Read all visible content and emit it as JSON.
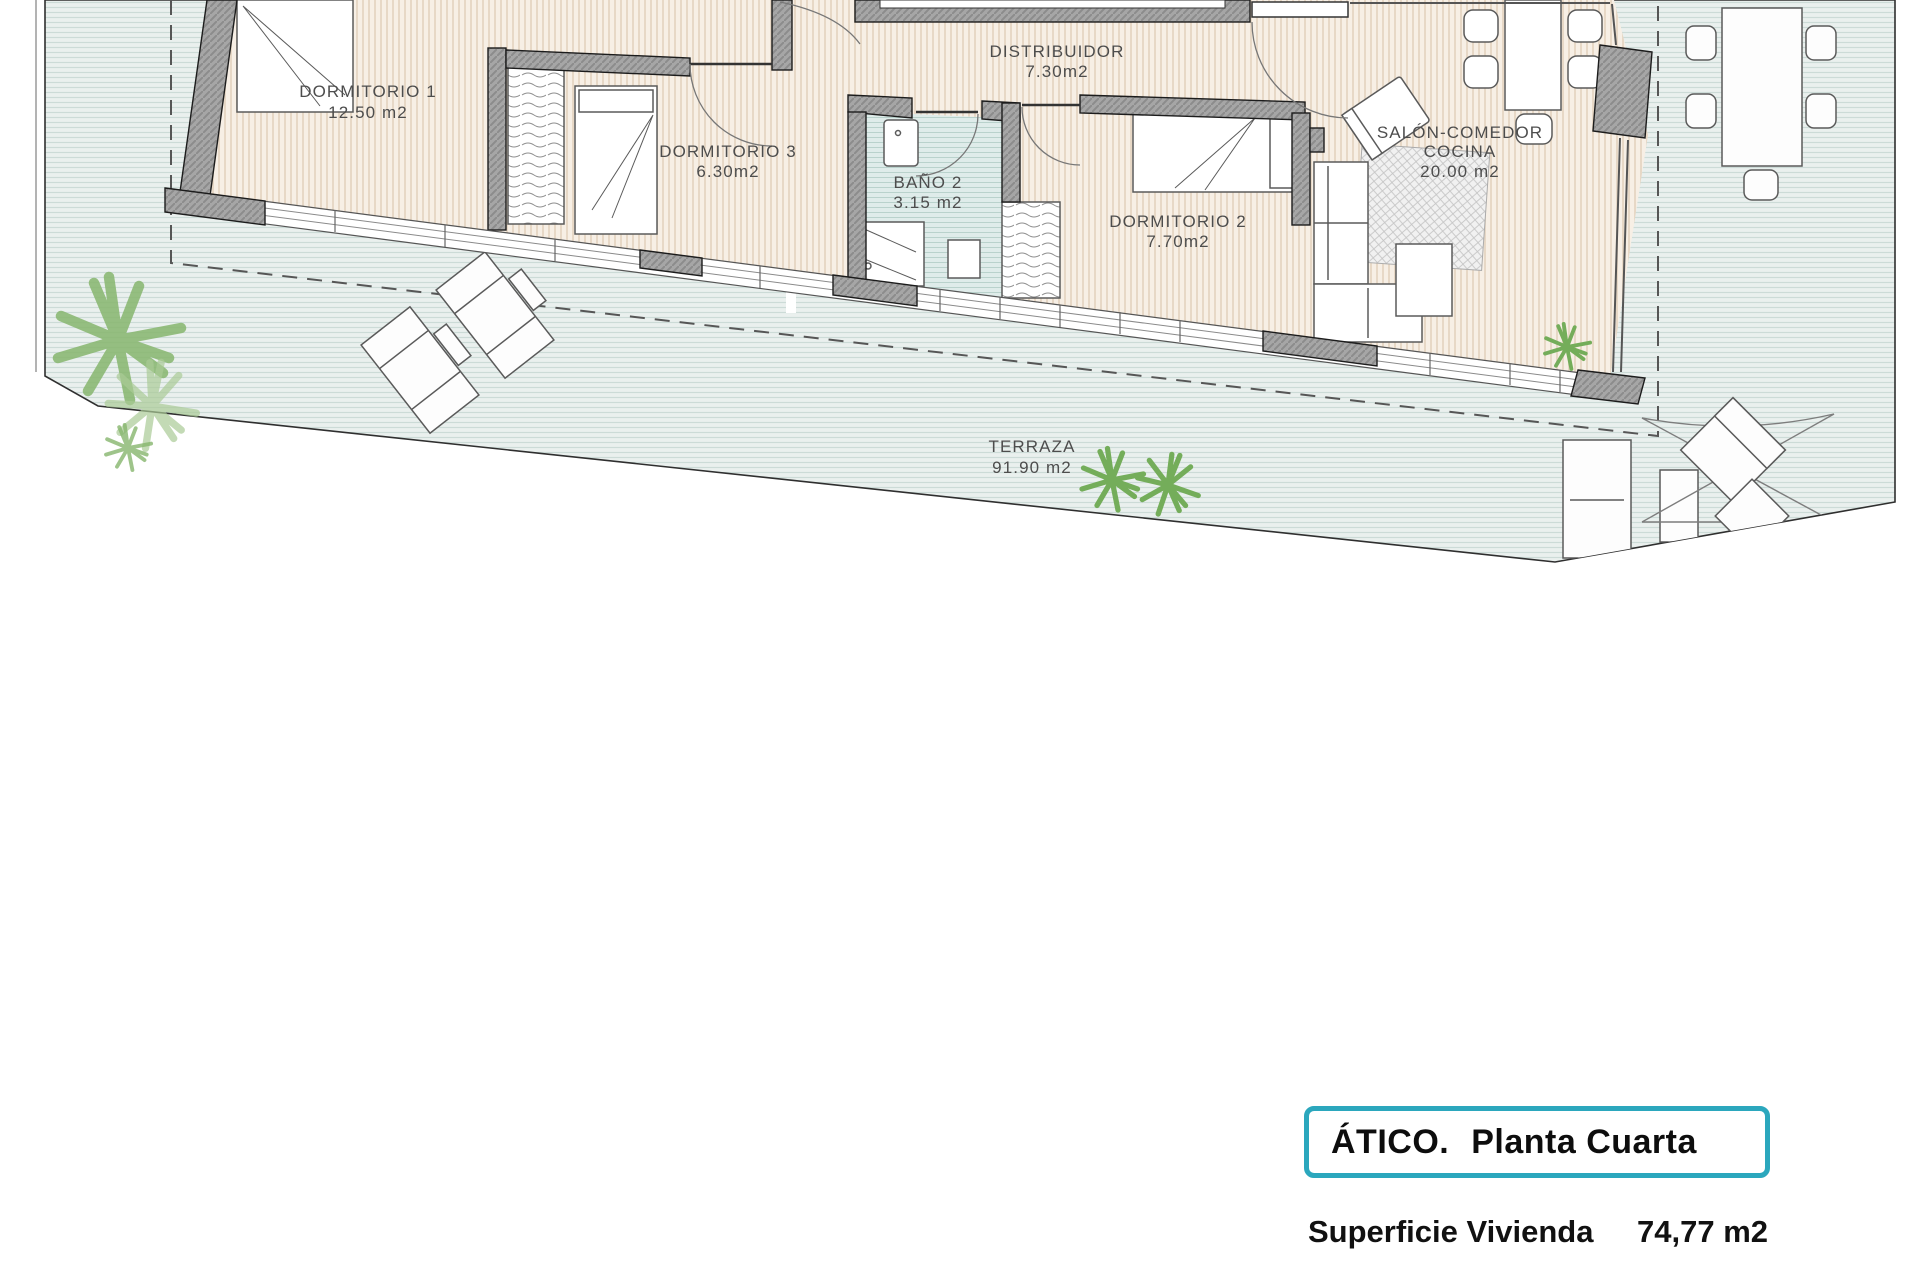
{
  "plan": {
    "rooms": {
      "dormitorio1": {
        "name": "DORMITORIO 1",
        "area": "12.50 m2"
      },
      "dormitorio3": {
        "name": "DORMITORIO 3",
        "area": "6.30m2"
      },
      "bano2": {
        "name": "BAÑO 2",
        "area": "3.15 m2"
      },
      "distribuidor": {
        "name": "DISTRIBUIDOR",
        "area": "7.30m2"
      },
      "dormitorio2": {
        "name": "DORMITORIO 2",
        "area": "7.70m2"
      },
      "salon": {
        "name_line1": "SALÓN-COMEDOR",
        "name_line2": "COCINA",
        "area": "20.00 m2"
      },
      "terraza": {
        "name": "TERRAZA",
        "area": "91.90 m2"
      }
    }
  },
  "info_box": {
    "title": "ÁTICO.",
    "subtitle": "Planta Cuarta",
    "surface_label": "Superficie Vivienda",
    "surface_value": "74,77 m2"
  },
  "colors": {
    "accent_teal": "#2ba7bd",
    "interior_floor": "#f7efe5",
    "terrace_floor": "#eaf0ee",
    "bath_floor": "#dfecea",
    "wall_grey": "#a6a6a6",
    "plant_green": "#86b56d",
    "label_grey": "#4d4d4d"
  }
}
